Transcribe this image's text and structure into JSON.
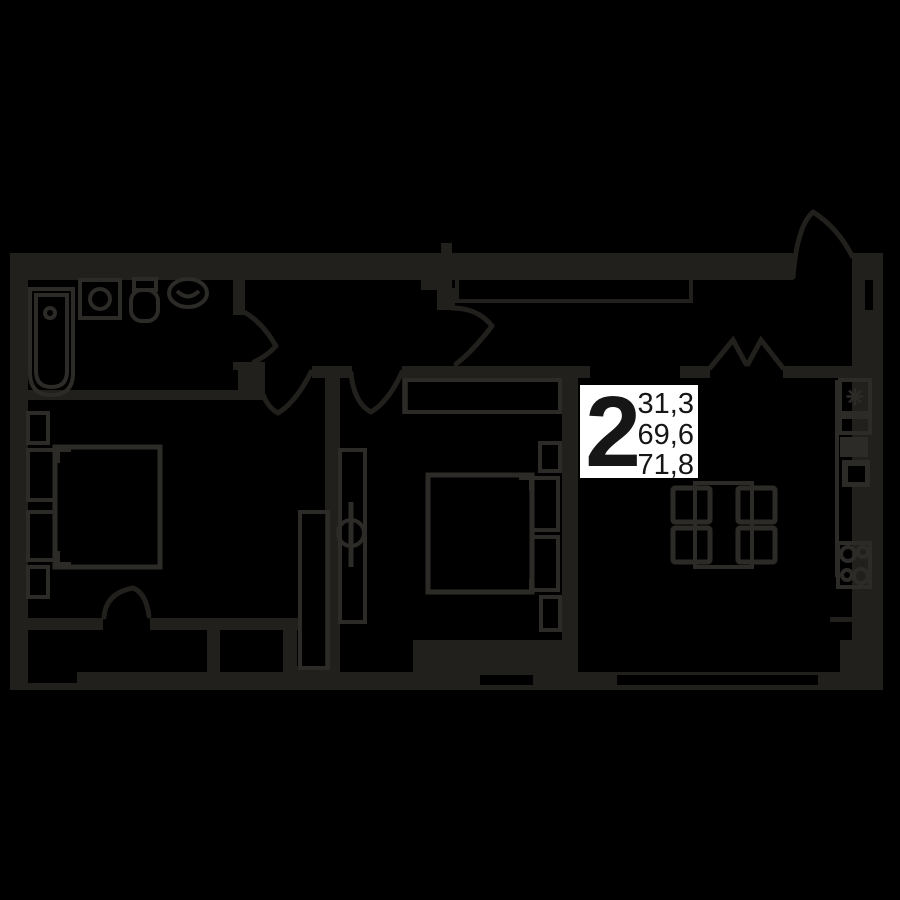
{
  "palette": {
    "bg": "#000000",
    "wall": "#21201d",
    "furniture": "#2c2b28",
    "label_bg": "#ffffff",
    "label_text": "#161616"
  },
  "unit_card": {
    "rooms": "2",
    "area_living": "31,3",
    "area_area": "69,6",
    "area_total": "71,8"
  },
  "icons": {
    "fridge": "snowflake"
  }
}
